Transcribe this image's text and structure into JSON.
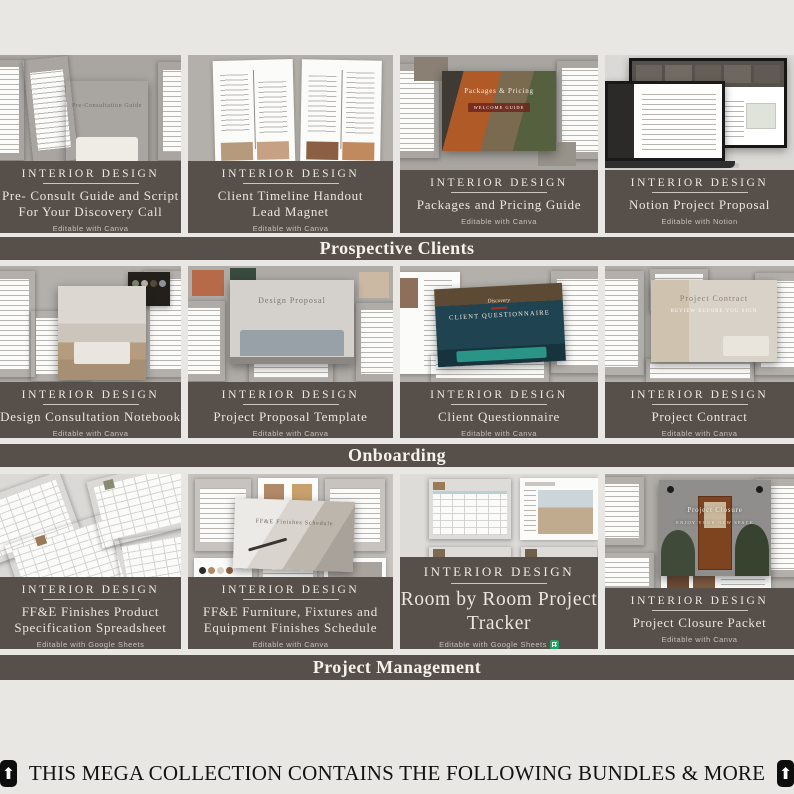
{
  "page": {
    "background": "#e8e7e4",
    "accent_dark": "#57504a",
    "banner_text_color": "#f5f2ec",
    "note_text_color": "#121212"
  },
  "sections": [
    {
      "banner": "Prospective Clients",
      "cards": [
        {
          "brand": "INTERIOR DESIGN",
          "title": "Pre- Consult Guide and Script\nFor Your Discovery Call",
          "subtitle": "Editable with Canva",
          "cover": "Pre-Consultation Guide"
        },
        {
          "brand": "INTERIOR DESIGN",
          "title": "Client Timeline Handout\nLead Magnet",
          "subtitle": "Editable with Canva",
          "cover": ""
        },
        {
          "brand": "INTERIOR DESIGN",
          "title": "Packages and Pricing Guide",
          "subtitle": "Editable with Canva",
          "cover": "Packages & Pricing",
          "cover2": "WELCOME GUIDE"
        },
        {
          "brand": "INTERIOR DESIGN",
          "title": "Notion Project Proposal",
          "subtitle": "Editable with Notion",
          "cover": "Interior Design Project Proposal"
        }
      ]
    },
    {
      "banner": "Onboarding",
      "cards": [
        {
          "brand": "INTERIOR DESIGN",
          "title": "Design Consultation Notebook",
          "subtitle": "Editable with Canva",
          "cover": ""
        },
        {
          "brand": "INTERIOR DESIGN",
          "title": "Project Proposal Template",
          "subtitle": "Editable with Canva",
          "cover": "Design Proposal"
        },
        {
          "brand": "INTERIOR DESIGN",
          "title": "Client Questionnaire",
          "subtitle": "Editable with Canva",
          "cover": "CLIENT QUESTIONNAIRE"
        },
        {
          "brand": "INTERIOR DESIGN",
          "title": "Project Contract",
          "subtitle": "Editable with Canva",
          "cover": "Project Contract",
          "cover2": "REVIEW BEFORE YOU SIGN"
        }
      ]
    },
    {
      "banner": "Project Management",
      "cards": [
        {
          "brand": "INTERIOR DESIGN",
          "title": "FF&E Finishes Product\nSpecification Spreadsheet",
          "subtitle": "Editable with Google Sheets",
          "cover": ""
        },
        {
          "brand": "INTERIOR DESIGN",
          "title": "FF&E Furniture, Fixtures and\nEquipment Finishes Schedule",
          "subtitle": "Editable with Canva",
          "cover": "FF&E Finishes Schedule"
        },
        {
          "brand": "INTERIOR DESIGN",
          "title": "Room by Room Project Tracker",
          "subtitle": "Editable with Google Sheets",
          "cover": ""
        },
        {
          "brand": "INTERIOR DESIGN",
          "title": "Project Closure Packet",
          "subtitle": "Editable with Canva",
          "cover": "Project Closure",
          "cover2": "ENJOY YOUR NEW SPACE"
        }
      ]
    }
  ],
  "footer_note": {
    "up_arrow": "⬆",
    "text": "THIS MEGA COLLECTION CONTAINS THE FOLLOWING BUNDLES & MORE"
  }
}
